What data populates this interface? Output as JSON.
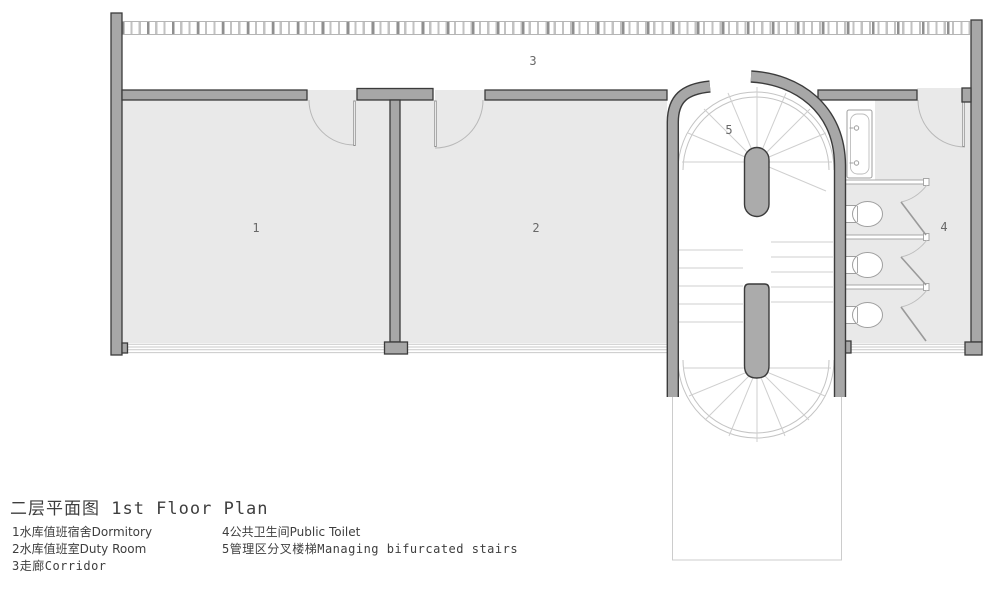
{
  "title": {
    "text": "二层平面图 1st Floor Plan"
  },
  "plan": {
    "labels": [
      {
        "id": "room-1",
        "text": "1"
      },
      {
        "id": "room-2",
        "text": "2"
      },
      {
        "id": "corridor-3",
        "text": "3"
      },
      {
        "id": "toilet-4",
        "text": "4"
      },
      {
        "id": "stair-5",
        "text": "5"
      }
    ]
  },
  "legend": {
    "column1": [
      {
        "text": "1水库值班宿舍Dormitory"
      },
      {
        "text": "2水库值班室Duty Room"
      },
      {
        "text": "3走廊Corridor"
      }
    ],
    "column2": [
      {
        "text": "4公共卫生间Public Toilet"
      },
      {
        "text": "5管理区分叉楼梯Managing bifurcated stairs"
      }
    ]
  },
  "colors": {
    "wall_fill": "#a7a7a7",
    "wall_outline": "#3b3b3b",
    "room_fill": "#e9e9e9",
    "light_line": "#c9c9c9",
    "text": "#4a4a4a"
  }
}
